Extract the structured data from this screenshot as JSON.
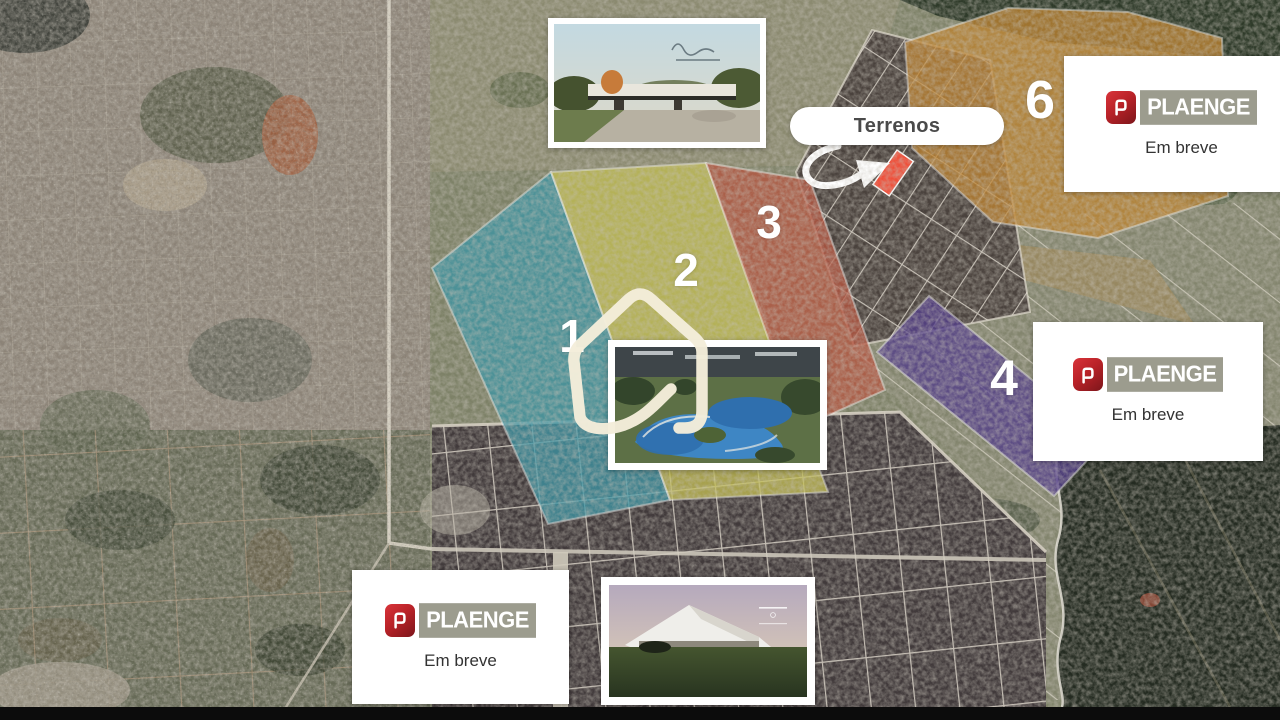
{
  "map": {
    "terrenos": {
      "label": "Terrenos"
    },
    "highlight": {
      "color": "#ef503b"
    },
    "zones": {
      "z1": {
        "label": "1",
        "color": "#3f96a5"
      },
      "z2": {
        "label": "2",
        "color": "#c4bf55"
      },
      "z3": {
        "label": "3",
        "color": "#b65843"
      },
      "z4": {
        "label": "4",
        "color": "#55418a"
      },
      "z6": {
        "label": "6",
        "color": "#bf8533"
      }
    }
  },
  "cards": {
    "plaenge_top_right": {
      "brand": "PLAENGE",
      "status": "Em breve"
    },
    "plaenge_right": {
      "brand": "PLAENGE",
      "status": "Em breve"
    },
    "plaenge_bottom_left": {
      "brand": "PLAENGE",
      "status": "Em breve"
    }
  }
}
